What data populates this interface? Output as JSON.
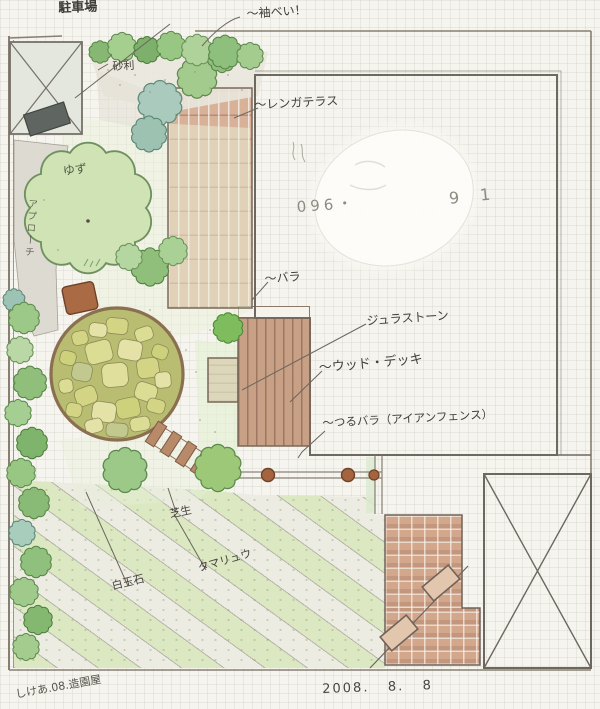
{
  "drawing": {
    "type": "hand-drawn garden landscape plan",
    "date": "2008.   8.   8",
    "credit": "しけあ.08.造園屋",
    "phone_left": "096・",
    "phone_right": "9 1"
  },
  "labels": {
    "parking": "駐車場",
    "top_note": "〜袖べい！",
    "gravel": "砂利",
    "yuzu": "ゆず",
    "approach": "アプローチ",
    "brick_terrace": "〜レンガテラス",
    "rose": "〜バラ",
    "jura_stone": "ジュラストーン",
    "wood_deck": "〜ウッド・デッキ",
    "fence": "〜つるバラ（アイアンフェンス）",
    "lawn": "芝生",
    "white_stone": "白玉石",
    "ground_cover": "タマリュウ"
  },
  "colors": {
    "paper": "#f6f4ee",
    "pencil": "#6b665e",
    "brick_terrace": "#d8b199",
    "wood_deck": "#c8a086",
    "patio_brick": "#d2a78c",
    "stone_circle": "#d8d98e",
    "foliage_green": "#9cc888",
    "foliage_teal": "#a9cabc",
    "fence_post_rust": "#a5643f"
  }
}
